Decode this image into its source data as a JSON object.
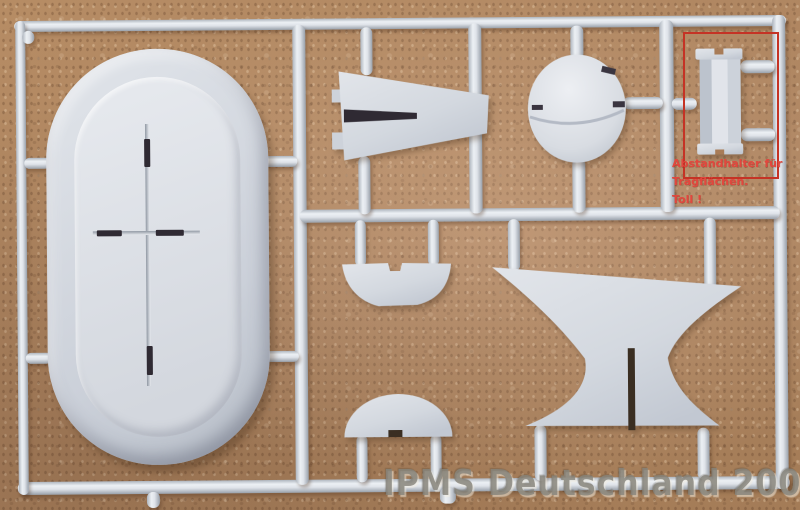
{
  "annotation": {
    "line1": "Abstandhalter für",
    "line2": "Tragflächen.",
    "line3": "Toll !",
    "text_color": "#e2473e",
    "box_color": "#c53325"
  },
  "watermark": {
    "text": "IPMS Deutschland 2008",
    "color": "#88857c"
  },
  "colors": {
    "cork_background": "#b1875f",
    "plastic": "#d4d9e0",
    "plastic_highlight": "#ecf0f4",
    "plastic_shadow": "#98a0aa",
    "slot_dark": "#2f2a33"
  },
  "parts": [
    "float-top-panel",
    "tail-fin",
    "engine-cowling-dome",
    "wing-spacer",
    "hull-tray",
    "half-disc",
    "pylon-anvil"
  ]
}
